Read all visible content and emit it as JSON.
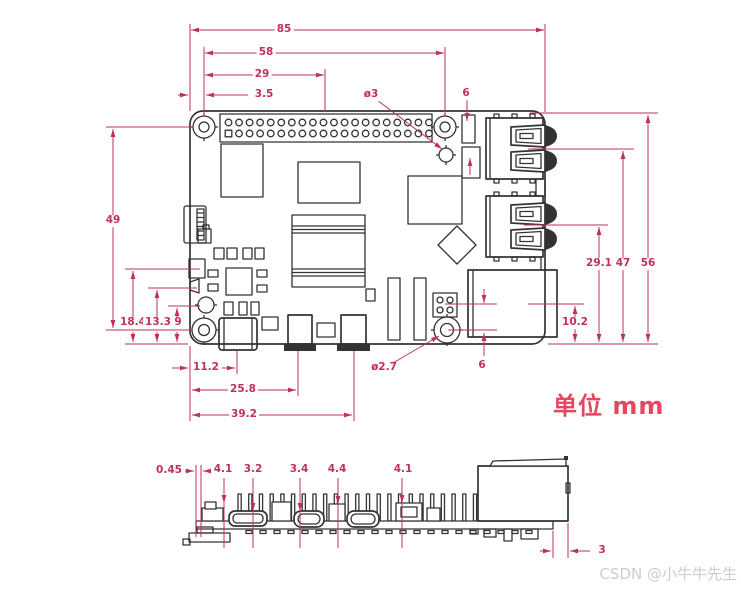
{
  "colors": {
    "dimension": "#bf3156",
    "line": "#333333",
    "unit_text": "#e8455f",
    "watermark": "#cccccc",
    "background": "#ffffff"
  },
  "unit_label": "单位 mm",
  "watermark": "CSDN @小牛牛先生",
  "dim_labels": {
    "top": [
      "85",
      "58",
      "29",
      "3.5",
      "ø3",
      "6"
    ],
    "left": [
      "49",
      "18.4",
      "13.3",
      "9"
    ],
    "right": [
      "29.1",
      "47",
      "56",
      "10.2"
    ],
    "bottom": [
      "11.2",
      "25.8",
      "39.2",
      "ø2.7",
      "6"
    ],
    "side": [
      "0.45",
      "4.1",
      "3.2",
      "3.4",
      "4.4",
      "4.1",
      "3"
    ]
  }
}
